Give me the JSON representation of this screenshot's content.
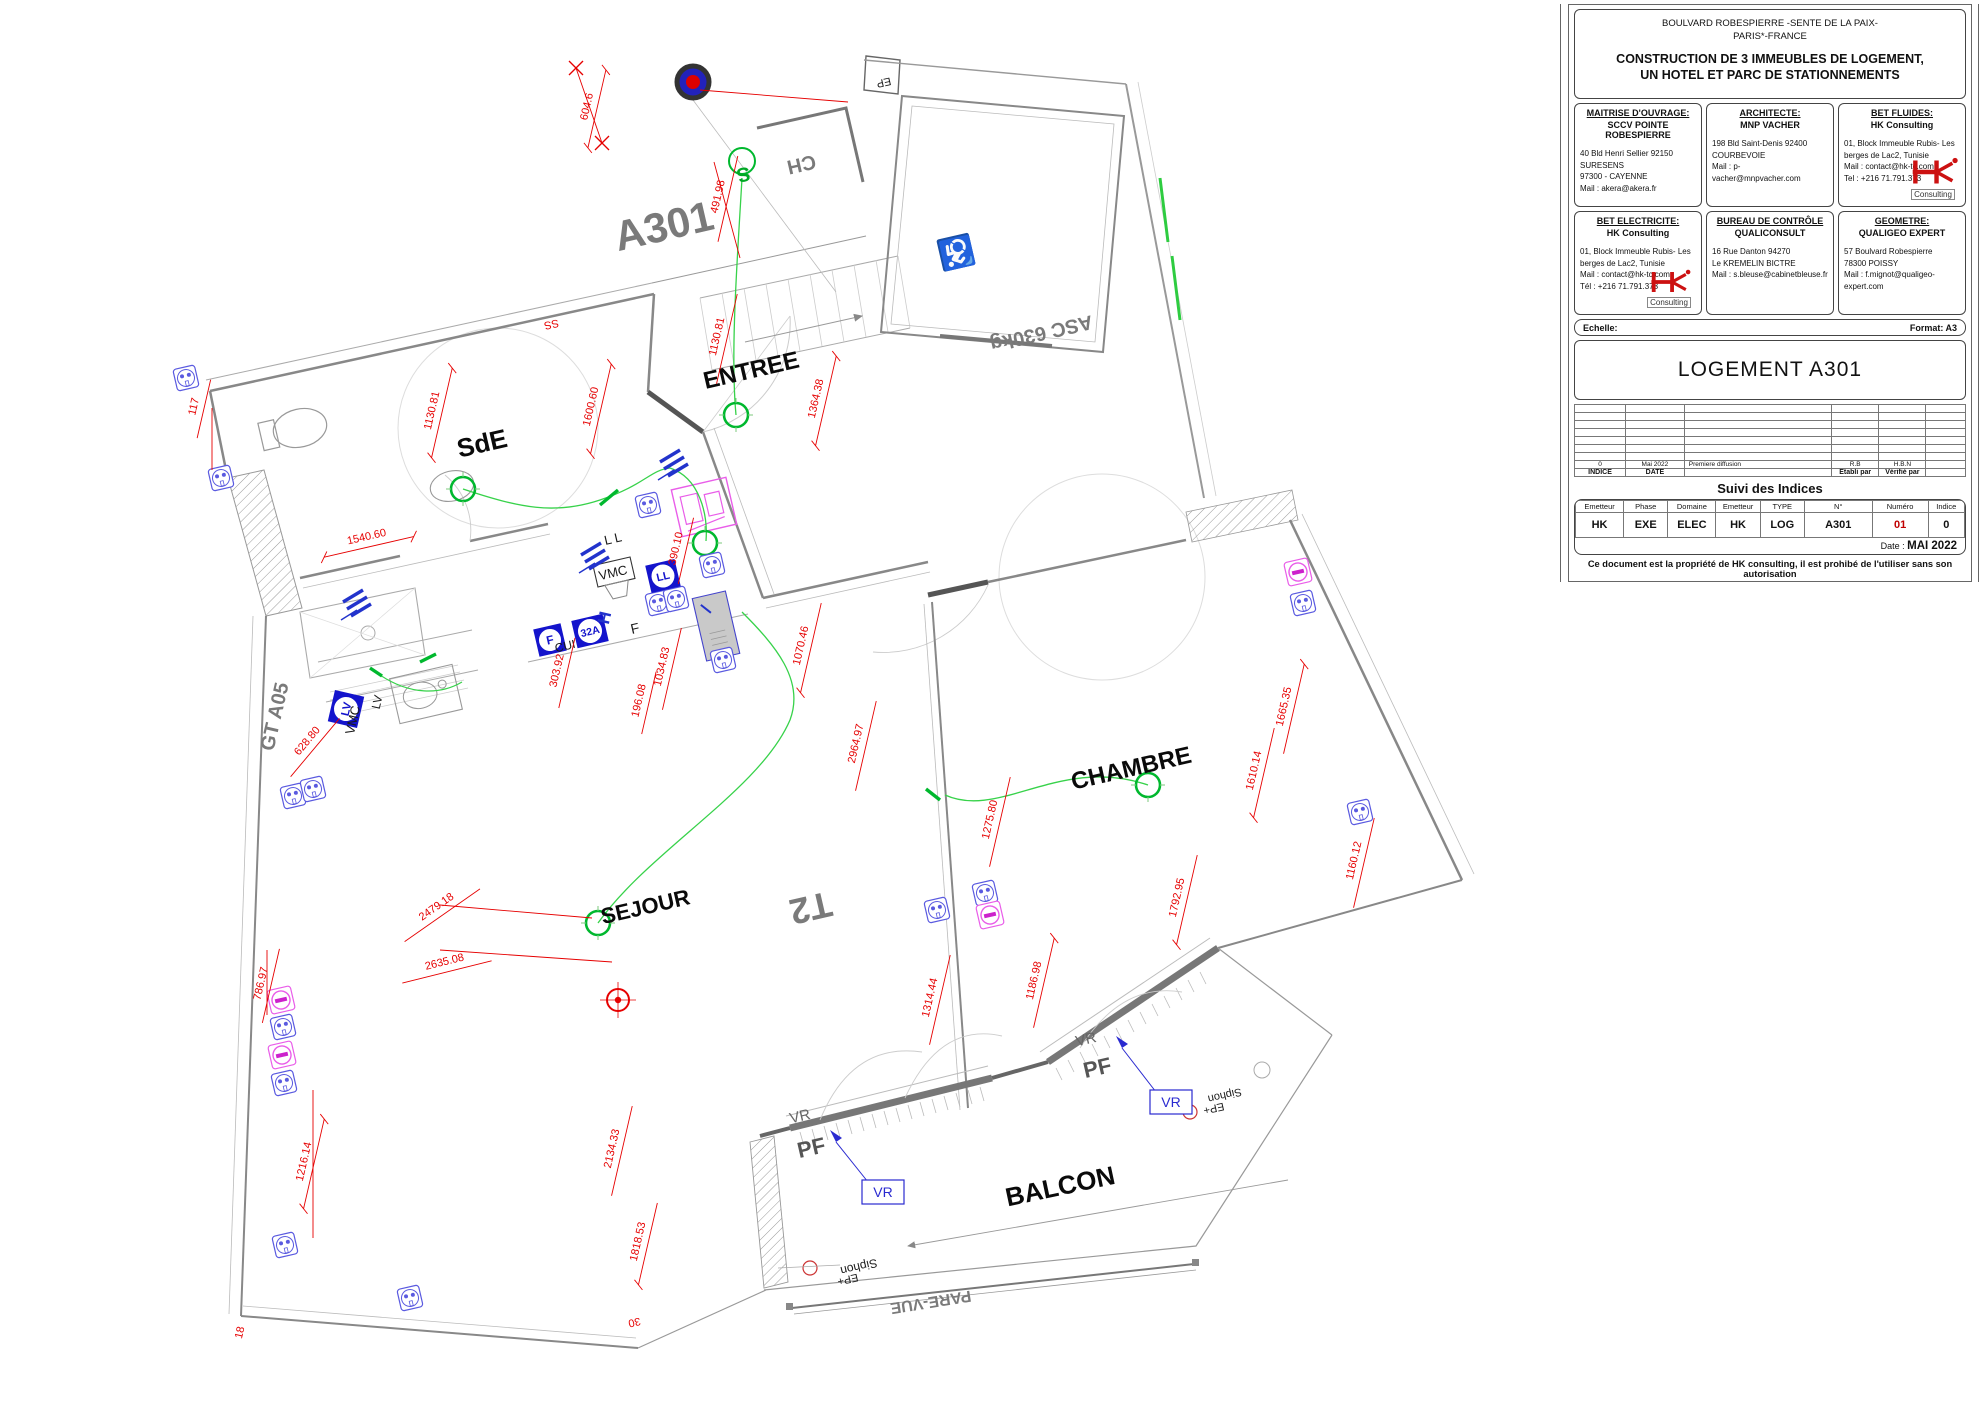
{
  "title_block": {
    "address_line1": "BOULVARD ROBESPIERRE -SENTE DE LA PAIX-",
    "address_line2": "PARIS*-FRANCE",
    "project_line1": "CONSTRUCTION DE 3 IMMEUBLES DE LOGEMENT,",
    "project_line2": "UN HOTEL ET PARC DE STATIONNEMENTS",
    "stakeholders": [
      {
        "title": "MAITRISE D'OUVRAGE:",
        "name": "SCCV POINTE ROBESPIERRE",
        "l1": "40 Bld Henri Sellier 92150 SURESENS",
        "l2": "97300 - CAYENNE",
        "l3": "Mail : akera@akera.fr",
        "l4": ""
      },
      {
        "title": "ARCHITECTE:",
        "name": "MNP VACHER",
        "l1": "198 Bld Saint-Denis 92400",
        "l2": "COURBEVOIE",
        "l3": "Mail : p-vacher@mnpvacher.com",
        "l4": ""
      },
      {
        "title": "BET FLUIDES:",
        "name": "HK Consulting",
        "l1": "01, Block Immeuble Rubis- Les",
        "l2": "berges de Lac2, Tunisie",
        "l3": "Mail : contact@hk-tc.com",
        "l4": "Tel : +216 71.791.373"
      },
      {
        "title": "BET ELECTRICITE:",
        "name": "HK Consulting",
        "l1": "01, Block Immeuble Rubis- Les",
        "l2": "berges de Lac2, Tunisie",
        "l3": "Mail : contact@hk-tc.com",
        "l4": "Tél : +216 71.791.373"
      },
      {
        "title": "BUREAU DE CONTRÔLE",
        "name": "QUALICONSULT",
        "l1": "16 Rue Danton 94270",
        "l2": "Le KREMELIN BICTRE",
        "l3": "Mail : s.bleuse@cabinetbleuse.fr",
        "l4": ""
      },
      {
        "title": "GEOMETRE:",
        "name": "QUALIGEO EXPERT",
        "l1": "57 Boulvard Robespierre",
        "l2": "78300 POISSY",
        "l3": "Mail : f.mignot@qualigeo-expert.com",
        "l4": ""
      }
    ],
    "logo_text": "Consulting",
    "echelle_label": "Echelle:",
    "format_label": "Format: A3",
    "drawing_title": "LOGEMENT A301",
    "revision": {
      "indice": "0",
      "date": "Mai 2022",
      "desc": "Premiere diffusion",
      "etabli": "R.B",
      "verifie": "H.B.N",
      "indice_h": "INDICE",
      "date_h": "DATE",
      "etabli_h": "Etabli par",
      "verifie_h": "Vérifié par"
    },
    "suivi_title": "Suivi des Indices",
    "meta_headers": [
      "Emetteur",
      "Phase",
      "Domaine",
      "Emetteur",
      "TYPE",
      "N°",
      "Numéro",
      "Indice"
    ],
    "meta_values": [
      "HK",
      "EXE",
      "ELEC",
      "HK",
      "LOG",
      "A301",
      "01",
      "0"
    ],
    "date_label": "Date :",
    "date_value": "MAI 2022",
    "footer": "Ce document est la propriété de HK consulting, il est prohibé de l'utiliser sans son autorisation"
  },
  "plan": {
    "rooms": [
      "SdE",
      "ENTREE",
      "SEJOUR",
      "CHAMBRE",
      "BALCON"
    ],
    "zones": [
      "A301",
      "T2",
      "CH",
      "ASC 630kg",
      "GT A05",
      "PARE-VUE",
      "EP"
    ],
    "dims": [
      "604.6",
      "491.98",
      "117",
      "1130.81",
      "1600.60",
      "1540.60",
      "1130.81",
      "1364.38",
      "390.10",
      "303.92",
      "1034.83",
      "196.08",
      "1070.46",
      "2964.97",
      "628.80",
      "2479.18",
      "2635.08",
      "786.97",
      "1216.14",
      "18",
      "2134.33",
      "1818.53",
      "30",
      "1314.44",
      "1186.98",
      "1275.80",
      "1792.95",
      "1160.12",
      "1610.14",
      "1665.35",
      "SS"
    ],
    "small": [
      "L L",
      "VMC",
      "VMC",
      "LV",
      "CUI",
      "F",
      "Siphon",
      "EP+",
      "Siphon",
      "EP+",
      "VR",
      "PF",
      "VR",
      "PF",
      "S"
    ],
    "blue": [
      "VR",
      "VR",
      "F",
      "32A",
      "LL",
      "LV",
      "H"
    ]
  }
}
